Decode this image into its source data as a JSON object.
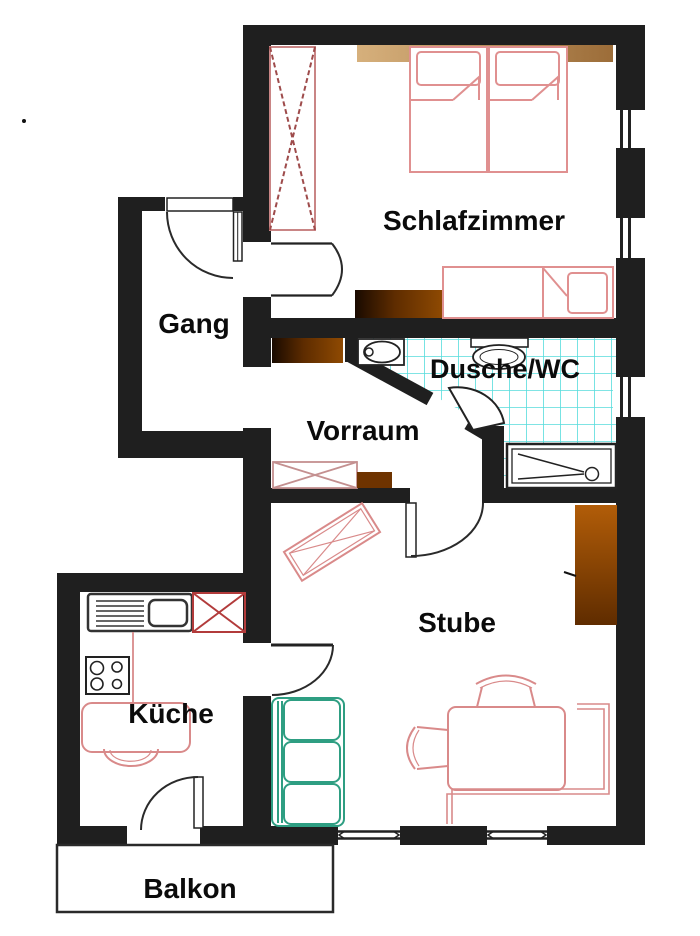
{
  "title": "Apartment floor plan",
  "rooms": {
    "schlafzimmer": {
      "label": "Schlafzimmer"
    },
    "gang": {
      "label": "Gang"
    },
    "dusche_wc": {
      "label": "Dusche/WC"
    },
    "vorraum": {
      "label": "Vorraum"
    },
    "stube": {
      "label": "Stube"
    },
    "kueche": {
      "label": "Küche"
    },
    "balkon": {
      "label": "Balkon"
    }
  },
  "colors": {
    "wall": "#1f1f1f",
    "furniture_pink": "#dd8f8f",
    "furniture_red": "#b23b3b",
    "couch_teal": "#2e9e82",
    "tile_cyan": "#55dcdc",
    "wood_tan": "#c8a06c",
    "wood_brown": "#7a3a00"
  }
}
